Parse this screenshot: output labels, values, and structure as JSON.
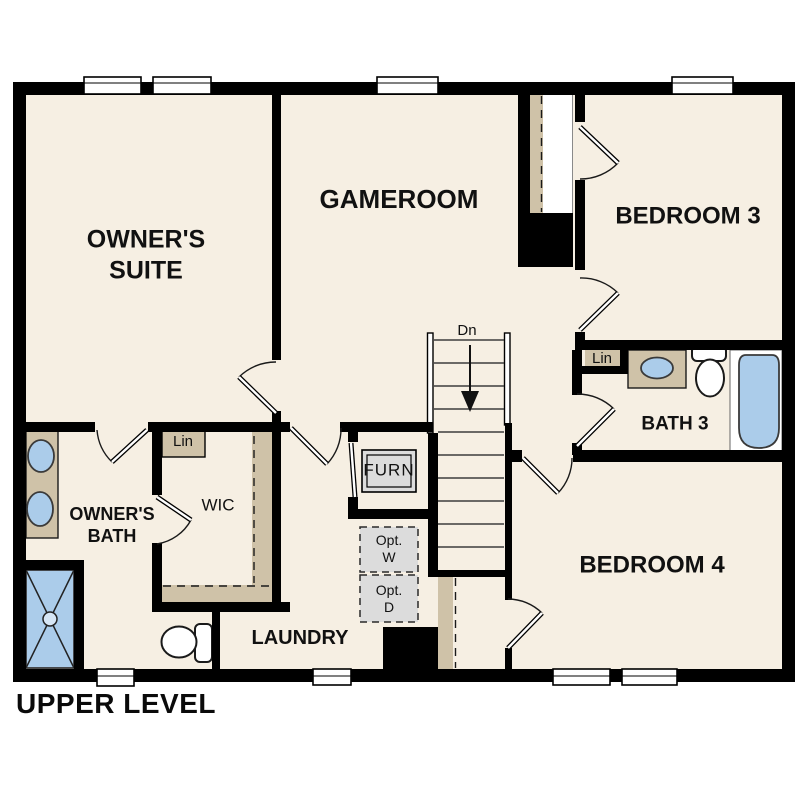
{
  "plan": {
    "level_label": "UPPER LEVEL",
    "rooms": {
      "owners_suite": {
        "line1": "OWNER'S",
        "line2": "SUITE"
      },
      "gameroom": {
        "label": "GAMEROOM"
      },
      "bedroom3": {
        "label": "BEDROOM 3"
      },
      "bath3": {
        "label": "BATH 3"
      },
      "bedroom4": {
        "label": "BEDROOM 4"
      },
      "owners_bath": {
        "line1": "OWNER'S",
        "line2": "BATH"
      },
      "wic": {
        "label": "WIC"
      },
      "laundry": {
        "label": "LAUNDRY"
      }
    },
    "closets": {
      "wic_linen": "Lin",
      "bath3_linen": "Lin"
    },
    "stairs": {
      "direction_label": "Dn"
    },
    "equipment": {
      "furnace": "FURN",
      "opt_washer_line1": "Opt.",
      "opt_washer_line2": "W",
      "opt_dryer_line1": "Opt.",
      "opt_dryer_line2": "D"
    },
    "colors": {
      "floor": "#f6efe3",
      "casework_tan": "#cfc2a8",
      "fixture_blue": "#abccea",
      "appliance_gray": "#dcdcdc",
      "wall_black": "#000000",
      "background": "#ffffff"
    }
  }
}
